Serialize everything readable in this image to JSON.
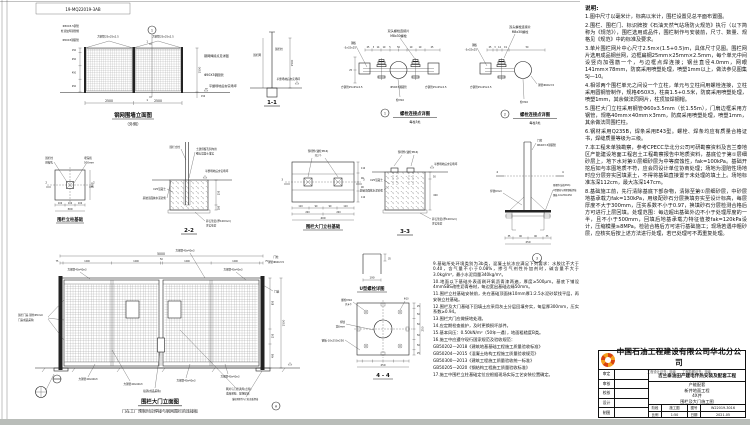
{
  "sheet": {
    "dwg_no": "19-MQ22019-3AB",
    "line_color": "#222222",
    "accent_orange": "#f5a01e",
    "accent_red": "#d8430f"
  },
  "fence": {
    "title": "钢网围墙立面图",
    "subtitle": "（外侧）",
    "badge": "1",
    "cut": "1",
    "labels_left": [
      "Φ50X3.5钢管",
      "柱顶加焊钢管帽",
      "Φ50X3钢圆管"
    ],
    "label_sq_l": "方钢管25x25x2.5",
    "label_sq_r": "方钢管25x25x2.5",
    "label_weld": "钢网焊接点见详图",
    "label_post_r": "Φ50X3钢圆管",
    "label_ground": "平整场地后夯实场坪",
    "dims": {
      "w1": "2500",
      "w2": "2500",
      "h": "1500",
      "h150": "150",
      "seg": [
        "150",
        "450",
        "450",
        "450"
      ]
    }
  },
  "sec11": {
    "title": "1-1",
    "label_net": "围栏网",
    "label_post": "围栏柱",
    "label_ground": "平整场地后夯实场坪",
    "dim_h": "1500"
  },
  "det1": {
    "badge": "1",
    "title": "螺栓连接点详图",
    "subtitle": "每柱3处",
    "label_top1": "双头螺栓连接片",
    "label_top2": "M8x30螺栓",
    "label_plate1": "钢板",
    "label_plate2": "-3x32x25",
    "label_sq_l": "方钢管25x25x2.5",
    "label_pipe": "Φ50X3钢圆管",
    "label_sq_r": "方钢管25x25x2.5",
    "label_bolt": "栓M10",
    "dim_25": "25",
    "dims": [
      "25",
      "3",
      "14",
      "19",
      "5",
      "50",
      "19",
      "19",
      "25"
    ]
  },
  "det2": {
    "badge": "2",
    "title": "螺栓连接点详图",
    "subtitle": "每柱3处",
    "label_top1": "双头螺栓连接片",
    "label_top2": "M8x30螺栓",
    "label_plate1": "钢板",
    "label_plate2": "-3x32x25",
    "label_sq": "方钢管25x25x2.5",
    "label_pipe_r": "钢管Φ60x3.5",
    "label_bolt": "栓M10",
    "dims": [
      "25",
      "3",
      "14",
      "19",
      "50"
    ]
  },
  "found1": {
    "title": "围栏立柱基础",
    "cut": "2",
    "label_l1": "围栏柱",
    "label_l2": "预留孔",
    "label_r1": "埋深按",
    "label_r2": "500mm",
    "dims_b": [
      "100",
      "100",
      "100"
    ],
    "total_b": "300",
    "total_r": "300"
  },
  "sec22": {
    "title": "2-2",
    "label_post": "围栏立柱",
    "label_hole1": "土建预留孔洞内用",
    "label_hole2": "细石混凝土灌实",
    "label_ground": "平整场地后夯实场坪",
    "label_conc": "C25混凝土",
    "label_mortar": "基础顶面抹水泥砂浆",
    "label_grav1": "碎石垫层(厚100mm)",
    "label_grav2": "夯实垫层",
    "dim_250": "250",
    "dim_100": "100"
  },
  "found2": {
    "title": "围栏大门立柱基础",
    "cut": "3",
    "label_embed1": "预埋件(锚栓M16)",
    "label_embed2": "共2个",
    "dims_b1": [
      "110",
      "90",
      "90",
      "110"
    ],
    "dims_b2": [
      "200",
      "200"
    ],
    "total": "400",
    "dims_r": [
      "110",
      "90",
      "90",
      "110"
    ]
  },
  "sec33": {
    "title": "3-3",
    "label_embed": "预埋件(锚栓M16)",
    "label_conc": "C25混凝土",
    "label_mortar": "基础顶面抹水泥砂浆",
    "label_ground": "平整场地后夯实场坪",
    "label_grav1": "碎石垫层(厚100mm)",
    "label_grav2": "夯实垫层",
    "dim_50": "50",
    "dim_600": "600"
  },
  "det3": {
    "badge": "3",
    "cut": "4",
    "label_post1": "门柱",
    "label_post2": "Φ60X3.5钢圆管",
    "label_weld": "焊缝6mm",
    "label_e1": "预埋件(锚栓M16)",
    "label_e2": "U型螺栓与预埋钢板焊接",
    "label_e3": "钢板-10x250x250",
    "dims_b": [
      "35",
      "90",
      "90",
      "35"
    ],
    "total": "250"
  },
  "gate": {
    "title": "围栏大门立面图",
    "subtitle": "门在工厂预制时应焊接与钢网围栏的连接板",
    "dim_total": "5000",
    "dims_top": [
      "75",
      "1200",
      "1200",
      "50",
      "1200",
      "1200",
      "75"
    ],
    "dims_r": [
      "850",
      "250",
      "400"
    ],
    "dim_h": "1500",
    "label_tl": "方钢管40x40x3",
    "label_tm": "方钢管40x40x3",
    "label_tr": "方钢管40x40x3",
    "label_post1": "门柱",
    "label_post2": "钢管Φ60x3.5",
    "label_door1": "围栏门扇 钢丝Φ5mm",
    "label_door2": "门扇成品采购",
    "labels_bottom": [
      "方钢管40x40x3",
      "方钢管40x40x3",
      "方钢管40x40x3",
      "方钢管40x40x3"
    ],
    "label_latch": "插销(成品采购)",
    "label_mesh1": "网片与门框满焊(点焊)",
    "label_mesh2": "成品采购、现场配钻",
    "label_axis": "门轴",
    "label_anchor": "锚栓预埋件与门柱底板焊接",
    "badge_a": "A"
  },
  "ubolt": {
    "title": "U型螺栓详图",
    "dim_w": "190",
    "dim_h": "35"
  },
  "sec44": {
    "title": "4 - 4",
    "label_bolt1": "螺栓M10",
    "label_bolt2": "共4个",
    "label_weld1": "焊缝",
    "label_weld2": "宽6mm",
    "label_plate": "钢板-10x250x250",
    "label_dia": "Φ10",
    "dims_b": [
      "25",
      "50",
      "50",
      "50",
      "50",
      "25"
    ],
    "total_b": "250",
    "total_r": "250"
  },
  "notes": {
    "heading": "说明:",
    "col1": [
      "1.图中尺寸以毫米计，标高以米计，围栏设置见总平面布置图。",
      "2.围栏、围栏门、标识牌按《石油天然气站场防火规范》执行（以下简称为《规范》），围栏选用成品件，围栏制作与安装前，尺寸、数量、规格见《规范》中的标准及要求。",
      "3.单片围栏网片中心尺寸2.5m×(1.5+0.5)m，具体尺寸见图。围栏网片选用成品钢丝网，边框扁钢25mm×25mm×2.5mm，每个单元中间设竖向加强筋一个，与边框点焊连接；钢丝直径4.0mm，网眼141mm×78mm，防腐采用喷塑处理，喷塑1mm以上，做法参见图集SJ—10。",
      "4.相邻两个围栏单元之间设一个立柱，单元与立柱间用螺栓连接，立柱采用圆钢管制作，规格Φ50X3，柱高1.5+0.5米，防腐采用喷塑处理，喷塑1mm，其余做法同网片，柱顶加焊钢帽。",
      "5.围栏大门立柱采用钢管Φ60x3.5mm（长1.55m），门扇边框采用方钢管，规格40mm×40mm×3mm，防腐采用喷塑处理，喷塑1mm，其余做法同围栏柱。",
      "6.钢材采用Q235B，焊条采用E43型。螺栓、焊条均应有质量合格证书，焊缝质量等级为三级。",
      "7.本工程未单独勘察，参考CPECC华北分公司可研勘察资料及吉兰泰地区产能建设地面工程岩土工程勘察报告中地质资料，基底位于第①层细砂层上，地下水对第①层细砂层为中等腐蚀性，fak=100kPa。基础开挖后如与本图地质不符，应会同设计单位协商处理；场地为湿陷性场地时应分层夯实回填素土，不得将基础直接置于未处理的填土上。场地标准冻深112cm，最大冻深147cm。",
      "8.基础施工前，先行清除基底下部杂物，清除至第①层细砂层，中砂层地基承载力fak=130kPa，用级配砂石分层换填夯实至设计标高，每层厚度不大于300mm，压实系数不小于0.97，换填砂石分层检测合格后方可进行上层回填。处理范围：每边超出基础外边不小于处理厚度的一半，且不小于500mm，回填后地基承载力特征值按fak=120kPa设计，压缩模量≥8MPa。检验合格后方可进行基础施工；现场若遇中粗砂层，应核实后按上述方法进行处理，若已处理可不再重复处理。"
    ],
    "col2": [
      "9.基础所处环境类别为3b类，混凝土抗冻应满足下列要求：水胶比不大于0.40，含气量不小于0.08%，掺引气剂性外加剂时，碱含量不大于3.0kg/m³，最小水泥用量340kg/m³。",
      "10.地面以下基础外表面刷环氧沥青漆两遍，厚度≥500μm。基底下铺设4mmSBS改性沥青卷材，每边宽出基础边缘50mm。",
      "11.围栏立柱基础安装前，先在基础顶面抹10mm厚1:2.5水泥砂浆找平层，再安装立柱基础。",
      "12.围栏及大门基础下回填土应采用灰土分层回填夯实，每层厚300mm，压实系数≥0.94。",
      "13.围栏大门应做接地处理。",
      "14.应定期检查维护，及时更换损坏部件。",
      "15.基本风压：0.50kN/m²（50年一遇），地面粗糙度B类。",
      "16.施工中应遵守现行国家规范及验收规范：",
      "GB50202—2018《建筑地基基础工程施工质量验收标准》",
      "GB50204—2015《混凝土结构工程施工质量验收规范》",
      "GB50300—2013《建筑工程施工质量验收统一标准》",
      "GB50205—2020《钢结构工程施工质量验收标准》",
      "17.施工中围栏立柱基础定位应根据现场实际工艺安装位置确定。"
    ]
  },
  "titleblock": {
    "company": "中国石油工程建设有限公司华北分公司",
    "cert": "工程设计证书：甲级　　工程勘察证书：甲级",
    "project": "吉兰泰油田产建电伴热安装及配套工程",
    "sign_rows": [
      {
        "label": "审定"
      },
      {
        "label": "审核"
      },
      {
        "label": "校核"
      },
      {
        "label": "设计"
      },
      {
        "label": "制图"
      }
    ],
    "block_lines": [
      "产能配套",
      "新井地面工程",
      "4X井",
      "围栏及大门施工图"
    ],
    "cells": [
      "阶段",
      "施工图",
      "图号",
      "W22019-3016",
      "比例",
      "1:50",
      "日期",
      "2021.05"
    ]
  }
}
